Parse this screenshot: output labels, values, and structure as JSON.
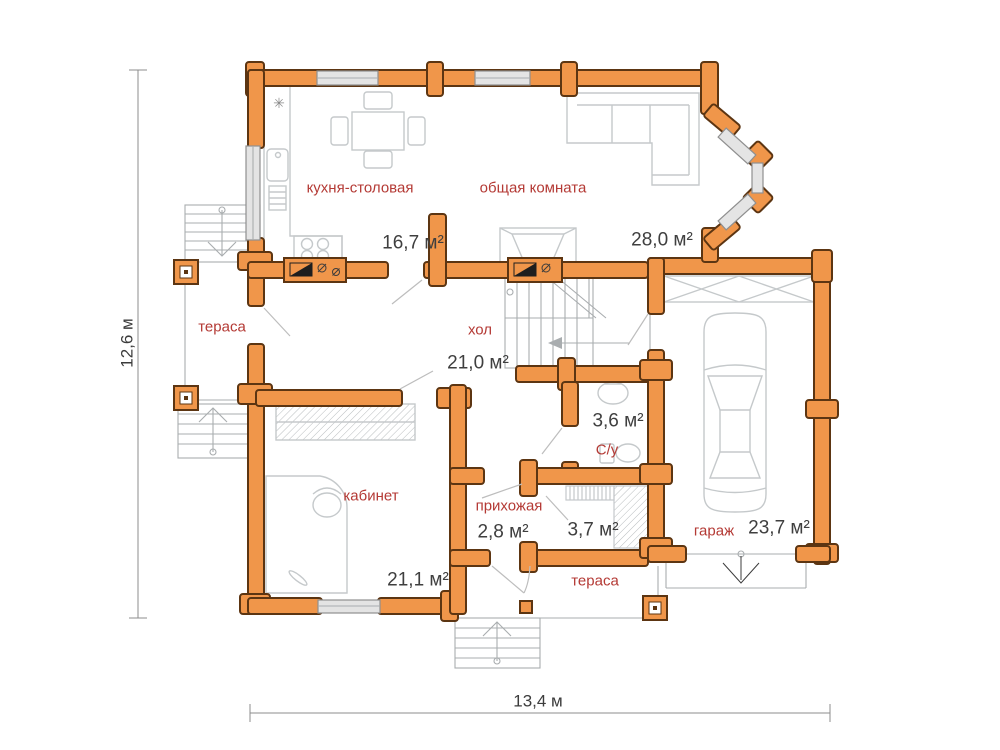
{
  "plan": {
    "title": "floor-plan",
    "colors": {
      "wall": "#f0964a",
      "wall_outline": "#5c3512",
      "room_label": "#b43a35",
      "area_text": "#3f3f3f",
      "furniture": "#c5c9cb",
      "window": "#e4e4e4"
    },
    "rooms": [
      {
        "id": "kitchen",
        "name": "кухня-столовая",
        "area": "16,7 м²"
      },
      {
        "id": "living",
        "name": "общая комната",
        "area": "28,0 м²"
      },
      {
        "id": "hall",
        "name": "хол",
        "area": "21,0 м²"
      },
      {
        "id": "terrace_left",
        "name": "тераса",
        "area": ""
      },
      {
        "id": "office",
        "name": "кабинет",
        "area": "21,1 м²"
      },
      {
        "id": "entry",
        "name": "прихожая",
        "area": "2,8 м²"
      },
      {
        "id": "closet",
        "name": "",
        "area": "3,7 м²"
      },
      {
        "id": "wc",
        "name": "С/у",
        "area": "3,6 м²"
      },
      {
        "id": "terrace_bottom",
        "name": "тераса",
        "area": ""
      },
      {
        "id": "garage",
        "name": "гараж",
        "area": "23,7 м²"
      }
    ],
    "dimensions": {
      "width_label": "13,4 м",
      "height_label": "12,6 м"
    },
    "icons": {
      "snowflake": "✳"
    }
  }
}
